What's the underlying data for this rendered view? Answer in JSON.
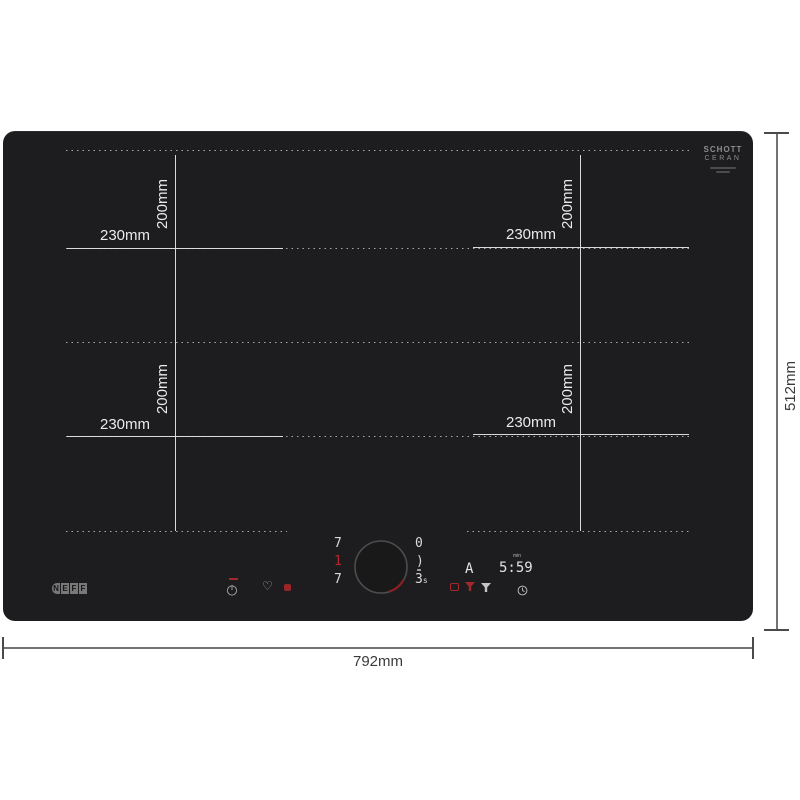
{
  "hob": {
    "brand": {
      "letters": [
        "N",
        "E",
        "F",
        "F"
      ]
    },
    "glass_logo": {
      "line1": "SCHOTT",
      "line2": "CERAN"
    },
    "zones": [
      {
        "name": "top-left",
        "width_label": "230mm",
        "height_label": "200mm"
      },
      {
        "name": "top-right",
        "width_label": "230mm",
        "height_label": "200mm"
      },
      {
        "name": "bottom-left",
        "width_label": "230mm",
        "height_label": "200mm"
      },
      {
        "name": "bottom-right",
        "width_label": "230mm",
        "height_label": "200mm"
      }
    ],
    "control_panel": {
      "left_zone_levels": {
        "top": "7",
        "middle": "1",
        "bottom": "7"
      },
      "right_zone_levels": {
        "top": "0",
        "middle": ")",
        "bottom": "3",
        "bottom_unit": "s"
      },
      "timer_display": {
        "mode": "A",
        "time": "5:59",
        "unit": "min"
      },
      "icons": {
        "heart_glyph": "♡",
        "names": [
          "power-icon",
          "favorite-heart-icon",
          "heat-indicator-dot",
          "pan-icon",
          "funnel-red-icon",
          "funnel-white-icon",
          "timer-clock-icon"
        ]
      }
    },
    "colors": {
      "surface": "#1d1d1f",
      "zone_line": "#e4e4e4",
      "red_accent": "#b3262a",
      "digit": "#d9d9d9"
    }
  },
  "dimensions": {
    "width": "792mm",
    "height": "512mm"
  }
}
